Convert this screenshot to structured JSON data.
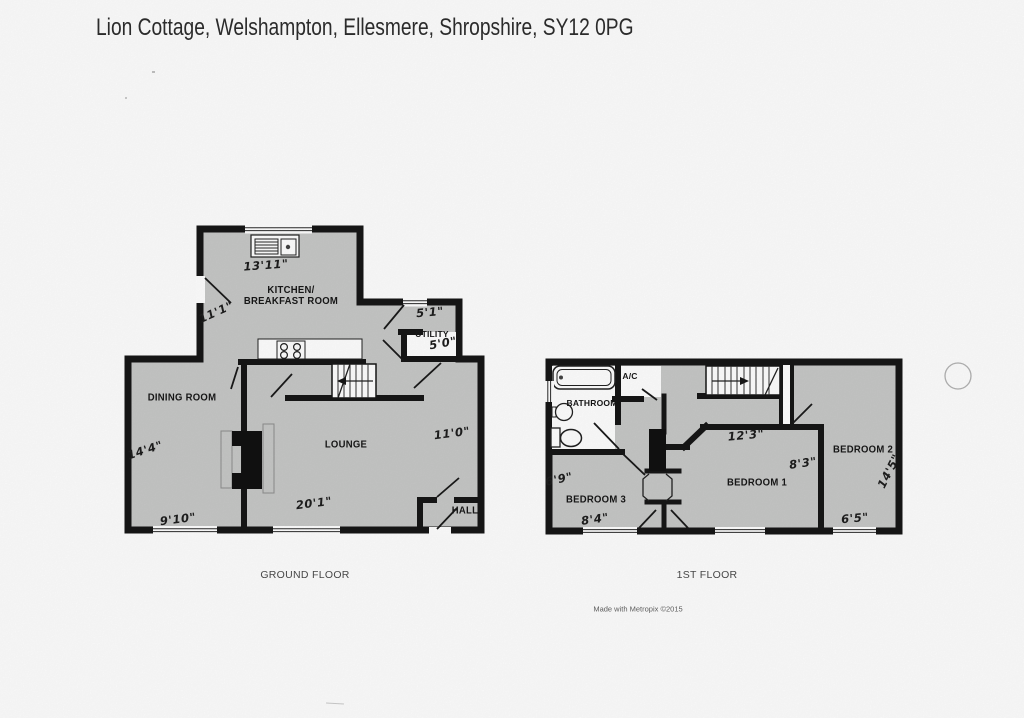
{
  "page": {
    "title": "Lion Cottage, Welshampton, Ellesmere, Shropshire, SY12 0PG",
    "credit": "Made with Metropix ©2015"
  },
  "ground_floor": {
    "caption": "GROUND FLOOR",
    "rooms": {
      "kitchen_line1": "KITCHEN/",
      "kitchen_line2": "BREAKFAST ROOM",
      "utility": "UTILITY",
      "dining_room": "DINING ROOM",
      "lounge": "LOUNGE",
      "hall": "HALL"
    },
    "dimensions": {
      "kitchen_width": "13'11\"",
      "kitchen_depth": "11'1\"",
      "utility_width": "5'1\"",
      "utility_depth": "5'0\"",
      "dining_depth": "14'4\"",
      "dining_width": "9'10\"",
      "lounge_width": "20'1\"",
      "lounge_depth": "11'0\""
    }
  },
  "first_floor": {
    "caption": "1ST FLOOR",
    "rooms": {
      "bathroom": "BATHROOM",
      "airing_cupboard": "A/C",
      "bedroom1": "BEDROOM 1",
      "bedroom2": "BEDROOM 2",
      "bedroom3": "BEDROOM 3"
    },
    "dimensions": {
      "bedroom1_width": "12'3\"",
      "bedroom1_depth": "8'3\"",
      "bedroom2_depth": "14'5\"",
      "bedroom2_width": "6'5\"",
      "bedroom3_depth": "6'9\"",
      "bedroom3_width": "8'4\""
    }
  },
  "colors": {
    "floor_fill": "#c7c8c7",
    "wall": "#161616",
    "paper": "#ffffff"
  }
}
